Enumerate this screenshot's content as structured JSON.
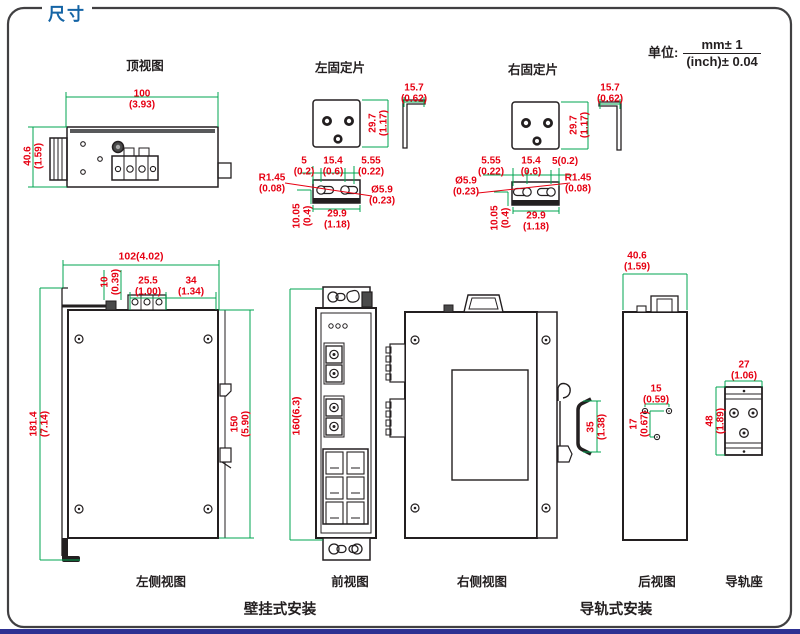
{
  "title": "尺寸",
  "unit": {
    "label": "单位:",
    "numerator": "mm± 1",
    "denominator": "(inch)± 0.04"
  },
  "captions": {
    "top_view": "顶视图",
    "left_plate": "左固定片",
    "right_plate": "右固定片",
    "left_side_view": "左侧视图",
    "front_view": "前视图",
    "right_side_view": "右侧视图",
    "rear_view": "后视图",
    "rail_mount": "导轨座",
    "wall_mount": "壁挂式安装",
    "din_mount": "导轨式安装"
  },
  "dims": {
    "top_view_width": {
      "mm": "100",
      "inch": "(3.93)"
    },
    "top_view_height": {
      "mm": "40.6",
      "inch": "(1.59)"
    },
    "left_plate_tab": {
      "mm": "15.7",
      "inch": "(0.62)"
    },
    "left_plate_height": {
      "mm": "29.7",
      "inch": "(1.17)"
    },
    "left_plate_edge": {
      "mm": "5",
      "inch": "(0.2)"
    },
    "left_plate_pitch": {
      "mm": "15.4",
      "inch": "(0.6)"
    },
    "left_plate_offset": {
      "mm": "5.55",
      "inch": "(0.22)"
    },
    "left_plate_radius": {
      "mm": "R1.45",
      "inch": "(0.08)"
    },
    "left_plate_hole": {
      "mm": "Ø5.9",
      "inch": "(0.23)"
    },
    "left_plate_depth": {
      "mm": "10.05",
      "inch": "(0.4)"
    },
    "left_plate_width": {
      "mm": "29.9",
      "inch": "(1.18)"
    },
    "right_plate_offset": {
      "mm": "5.55",
      "inch": "(0.22)"
    },
    "right_plate_pitch": {
      "mm": "15.4",
      "inch": "(0.6)"
    },
    "right_plate_edge": {
      "mm": "5(0.2)"
    },
    "right_plate_hole": {
      "mm": "Ø5.9",
      "inch": "(0.23)"
    },
    "right_plate_radius": {
      "mm": "R1.45",
      "inch": "(0.08)"
    },
    "right_plate_tab": {
      "mm": "15.7",
      "inch": "(0.62)"
    },
    "right_plate_height": {
      "mm": "29.7",
      "inch": "(1.17)"
    },
    "right_plate_depth": {
      "mm": "10.05",
      "inch": "(0.4)"
    },
    "right_plate_width": {
      "mm": "29.9",
      "inch": "(1.18)"
    },
    "side_width": {
      "mm": "102(4.02)"
    },
    "side_offset": {
      "mm": "10",
      "inch": "(0.39)"
    },
    "side_block": {
      "mm": "25.5",
      "inch": "(1.00)"
    },
    "side_right": {
      "mm": "34",
      "inch": "(1.34)"
    },
    "side_total_height": {
      "mm": "181.4",
      "inch": "(7.14)"
    },
    "side_body_height": {
      "mm": "150",
      "inch": "(5.90)"
    },
    "front_height": {
      "mm": "160(6.3)"
    },
    "din_rail_width": {
      "mm": "35",
      "inch": "(1.38)"
    },
    "rear_width": {
      "mm": "40.6",
      "inch": "(1.59)"
    },
    "rear_hole_pitch": {
      "mm": "15",
      "inch": "(0.59)"
    },
    "rear_hole_drop": {
      "mm": "17",
      "inch": "(0.67)"
    },
    "mount_width": {
      "mm": "27",
      "inch": "(1.06)"
    },
    "mount_height": {
      "mm": "48",
      "inch": "(1.89)"
    }
  },
  "colors": {
    "dimension_text": "#e60012",
    "dimension_line": "#00a651",
    "drawing_line": "#231f20",
    "title": "#1464a5",
    "footer_bar": "#2e3192"
  }
}
